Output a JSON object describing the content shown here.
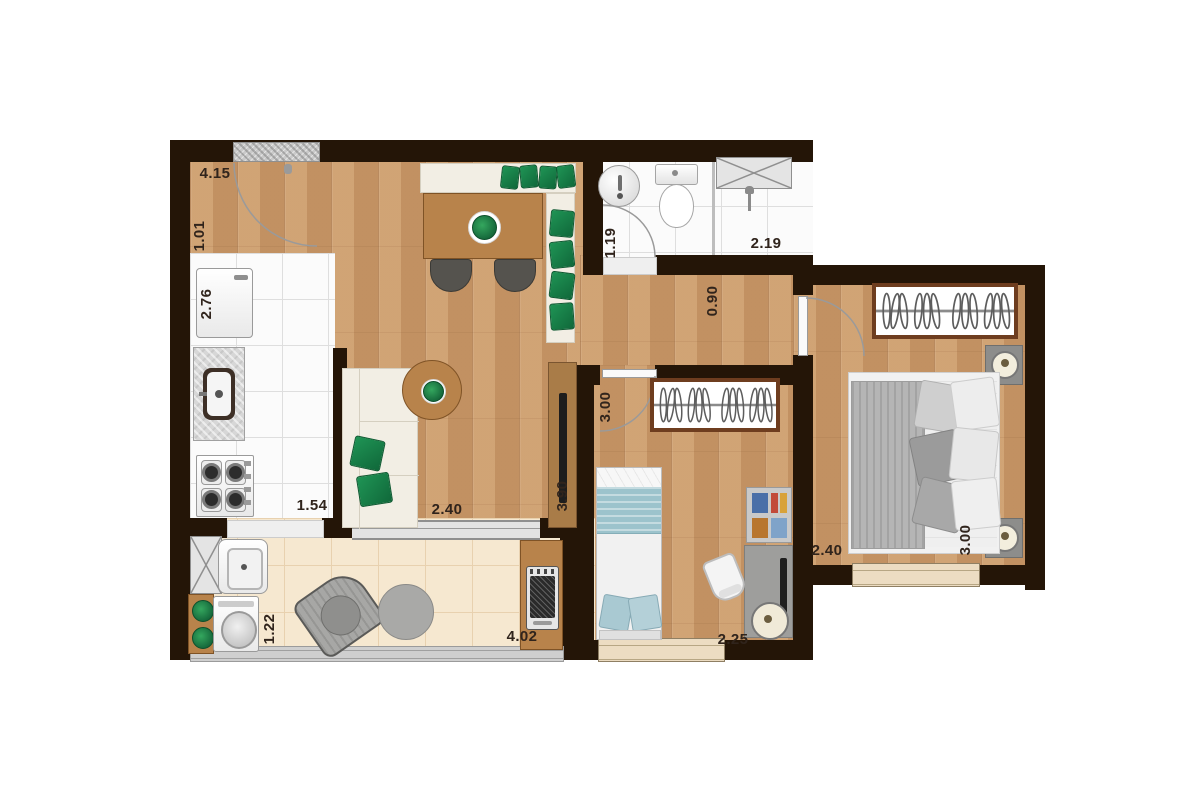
{
  "plan": {
    "type": "apartment-floor-plan",
    "palette": {
      "wall": "#241507",
      "wood_floor": "#c9996a",
      "tile_floor": "#fbfbfb",
      "balcony_floor": "#f6e8d0",
      "accent_green": "#1f9455",
      "teal_bedding": "#9cc3cc",
      "furniture_wood": "#b8834b"
    }
  },
  "dimension_labels": [
    {
      "text": "4.15",
      "room": "living-dining",
      "x": 215,
      "y": 174,
      "dir": "h"
    },
    {
      "text": "1.01",
      "room": "living-dining",
      "x": 200,
      "y": 236,
      "dir": "v"
    },
    {
      "text": "2.76",
      "room": "kitchen",
      "x": 207,
      "y": 304,
      "dir": "v"
    },
    {
      "text": "1.54",
      "room": "kitchen",
      "x": 312,
      "y": 506,
      "dir": "h"
    },
    {
      "text": "1.19",
      "room": "bathroom",
      "x": 611,
      "y": 243,
      "dir": "v"
    },
    {
      "text": "2.19",
      "room": "bathroom-shower",
      "x": 766,
      "y": 244,
      "dir": "h"
    },
    {
      "text": "0.90",
      "room": "corridor",
      "x": 713,
      "y": 301,
      "dir": "v"
    },
    {
      "text": "3.00",
      "room": "bedroom-2",
      "x": 606,
      "y": 407,
      "dir": "v"
    },
    {
      "text": "3.90",
      "room": "living-depth",
      "x": 563,
      "y": 496,
      "dir": "v"
    },
    {
      "text": "2.40",
      "room": "living-width",
      "x": 447,
      "y": 510,
      "dir": "h"
    },
    {
      "text": "1.22",
      "room": "balcony",
      "x": 270,
      "y": 629,
      "dir": "v"
    },
    {
      "text": "4.02",
      "room": "balcony",
      "x": 522,
      "y": 637,
      "dir": "h"
    },
    {
      "text": "2.25",
      "room": "bedroom-2",
      "x": 733,
      "y": 640,
      "dir": "h"
    },
    {
      "text": "2.40",
      "room": "master-bedroom",
      "x": 827,
      "y": 551,
      "dir": "h"
    },
    {
      "text": "3.00",
      "room": "master-bedroom",
      "x": 966,
      "y": 540,
      "dir": "v"
    }
  ]
}
